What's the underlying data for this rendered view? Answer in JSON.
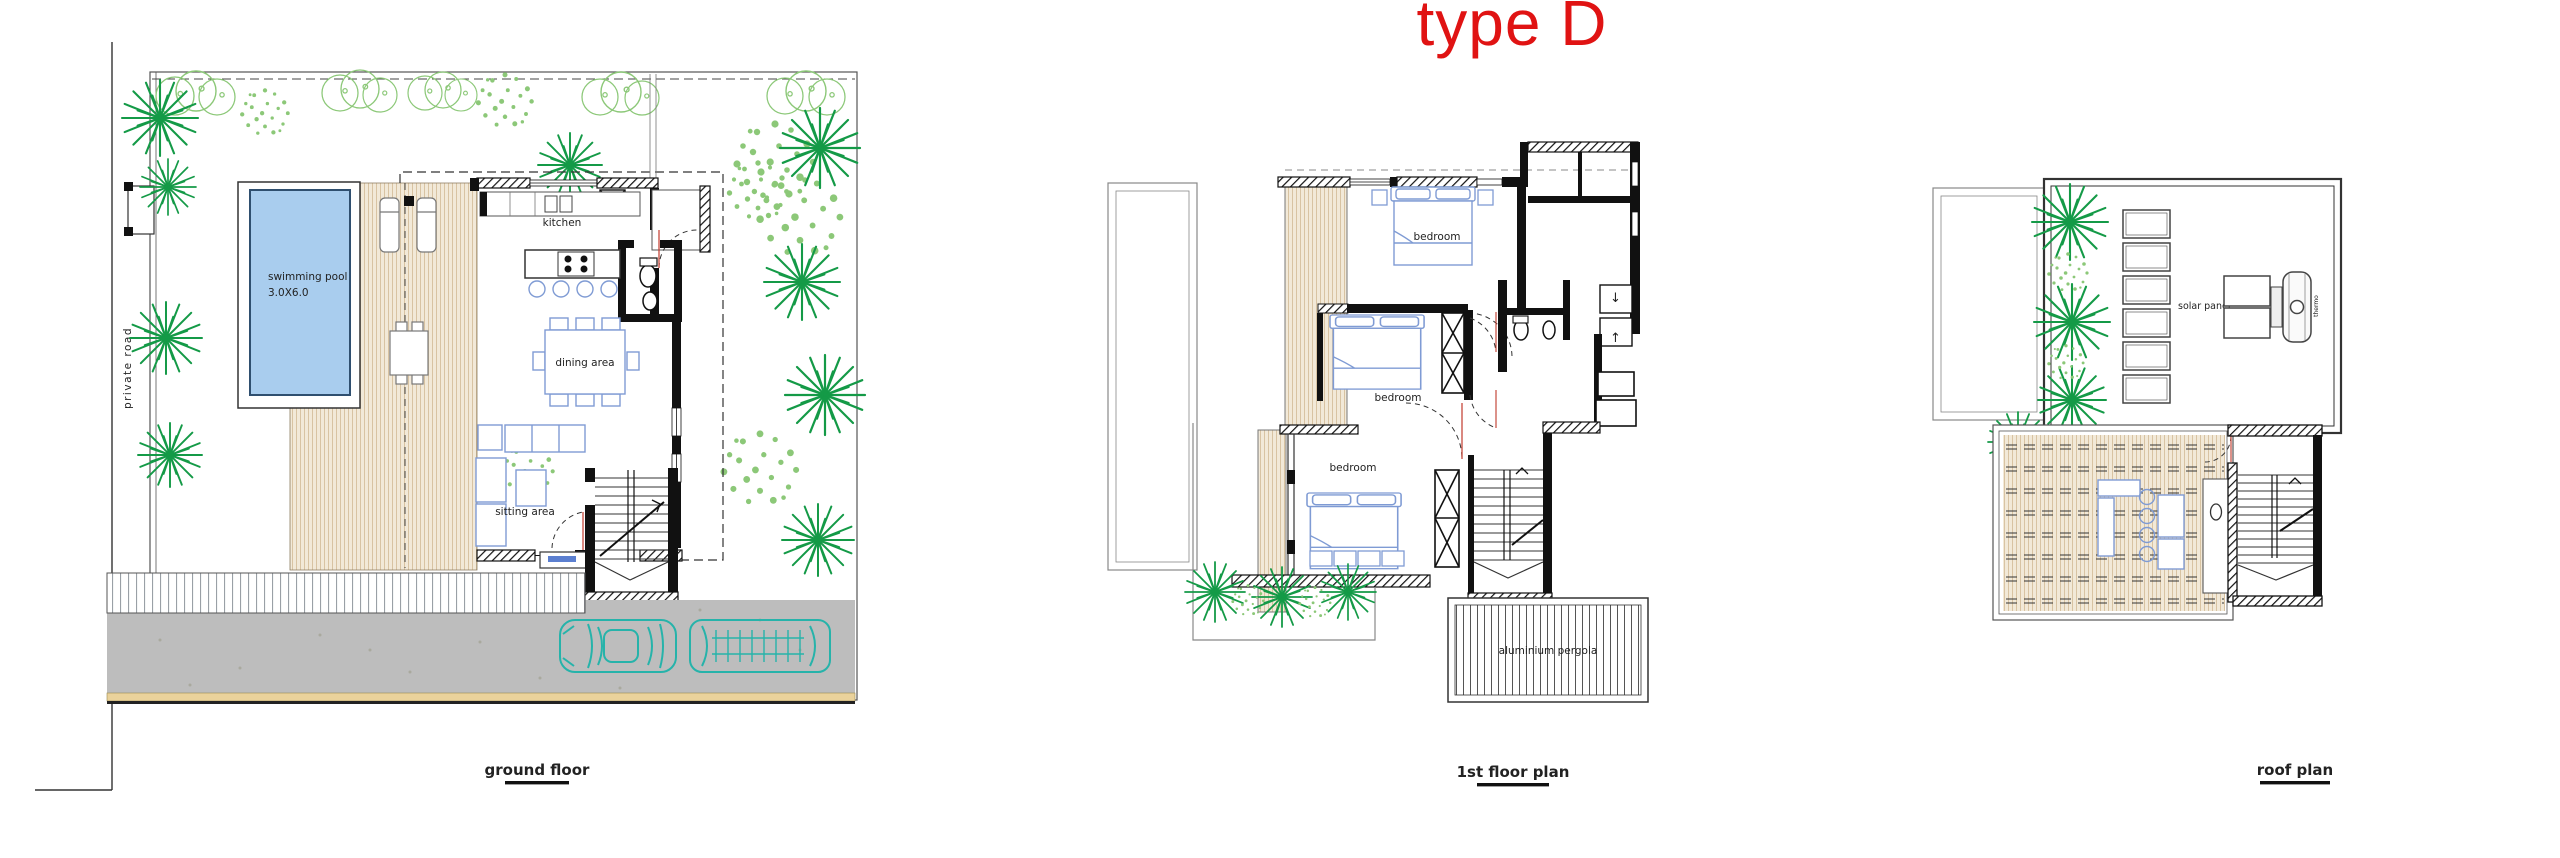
{
  "title": "type D",
  "plans": {
    "ground": {
      "caption": "ground floor",
      "road_label": "private road",
      "pool_label_line1": "swimming pool",
      "pool_label_line2": "3.0X6.0",
      "kitchen_label": "kitchen",
      "dining_label": "dining area",
      "sitting_label": "sitting area"
    },
    "first": {
      "caption": "1st floor plan",
      "bedrooms": [
        "bedroom",
        "bedroom",
        "bedroom"
      ],
      "pergola_label": "aluminium pergola"
    },
    "roof": {
      "caption": "roof plan",
      "solar_label": "solar panel",
      "heater_label": "thermo"
    }
  },
  "colors": {
    "title_red": "#e01313",
    "pool_fill": "#a9cdee",
    "pool_border": "#2f4f6f",
    "furniture_blue": "#7f9bd4",
    "deck_bg": "#f2e9d8",
    "deck_stripe": "#d8c3a2",
    "palm_green": "#149a47",
    "bush_green": "#8cc878",
    "driveway_gray": "#bdbdbd",
    "car_teal": "#26b3aa",
    "sand_strip": "#ead29b",
    "wall_black": "#111111",
    "door_red": "#c0392b"
  }
}
